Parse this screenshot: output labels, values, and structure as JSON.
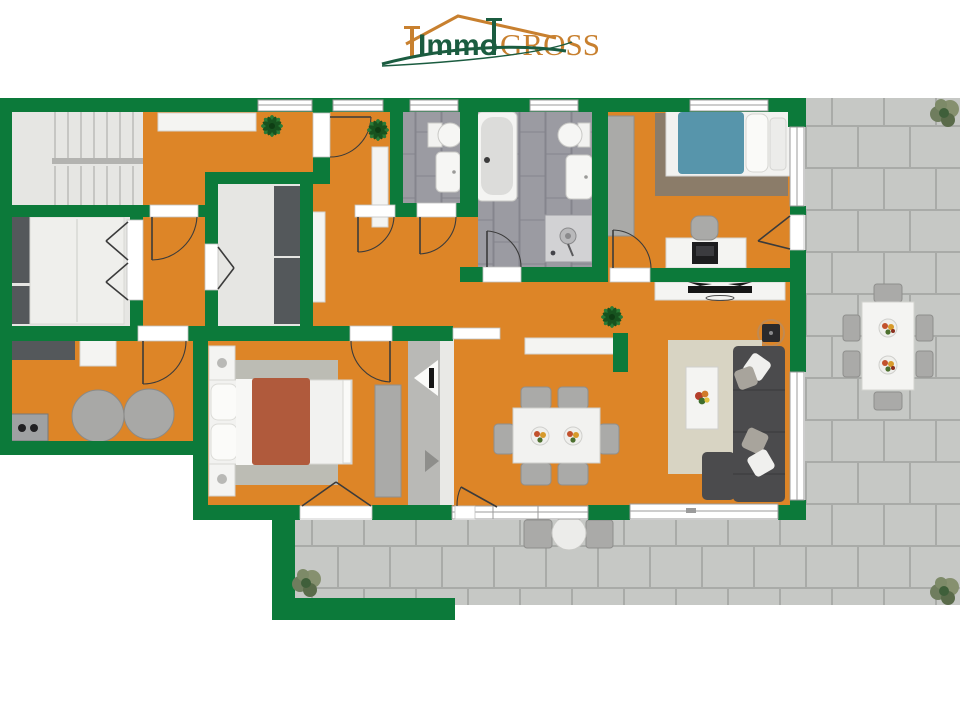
{
  "logo": {
    "brand_part1": "Immo",
    "brand_part2": "GROSS",
    "part1_color": "#1b5c40",
    "part2_color": "#c8802f",
    "roof_color": "#c8802f",
    "swoosh_color": "#1b5c40"
  },
  "colors": {
    "wall": "#0c7a3a",
    "floor": "#dd8527",
    "floor_light": "#e6e6e3",
    "tile": "#9b9ba2",
    "tile_grout": "#85858d",
    "paver": "#c6c8c5",
    "paver_joint": "#a9aba8",
    "furniture_dark": "#54585b",
    "furniture_gray": "#aaaaa8",
    "rug_beige": "#d8d4c3",
    "rug_brown": "#8b7c69",
    "rug_gray": "#bcbcb4",
    "bed_blue": "#5795ab",
    "bed_rust": "#b05a3c",
    "sofa": "#4b4b4d",
    "plant": "#1f6b2e"
  },
  "rooms": [
    {
      "id": "staircase"
    },
    {
      "id": "upper-hallway"
    },
    {
      "id": "bedroom-left"
    },
    {
      "id": "small-room"
    },
    {
      "id": "storage-room"
    },
    {
      "id": "corridor"
    },
    {
      "id": "wc"
    },
    {
      "id": "bathroom"
    },
    {
      "id": "bedroom-top-right"
    },
    {
      "id": "living-room"
    },
    {
      "id": "dining-area"
    },
    {
      "id": "master-bedroom"
    },
    {
      "id": "kitchen-utility"
    },
    {
      "id": "entry-hall"
    },
    {
      "id": "terrace"
    }
  ],
  "furniture": [
    "stairs",
    "wardrobes",
    "double-bed-white",
    "single-bed-blue",
    "double-bed-rust",
    "desk-with-laptop",
    "tv-sideboard",
    "sofa-l-shape",
    "coffee-table",
    "dining-table-6-chairs",
    "sideboard",
    "bathtub",
    "shower",
    "toilet",
    "washbasin",
    "washer-dryer",
    "kitchen-counter",
    "outdoor-dining-table-6-chairs",
    "bistro-set",
    "plants"
  ]
}
